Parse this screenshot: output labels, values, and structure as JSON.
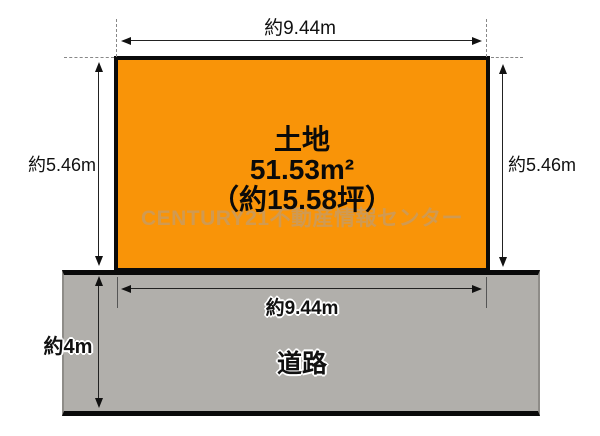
{
  "diagram": {
    "land": {
      "name": "土地",
      "area_m2": "51.53m²",
      "area_tsubo": "（約15.58坪）",
      "top_width_label": "約9.44m",
      "left_depth_label": "約5.46m",
      "right_depth_label": "約5.46m",
      "fill_color": "#f99408",
      "border_color": "#0a0a0a"
    },
    "road": {
      "name": "道路",
      "frontage_label": "約9.44m",
      "width_label": "約4m",
      "fill_color": "#b1afab"
    },
    "watermark": {
      "text": "CENTURY21不動産情報センター",
      "color": "#d09a52"
    }
  }
}
